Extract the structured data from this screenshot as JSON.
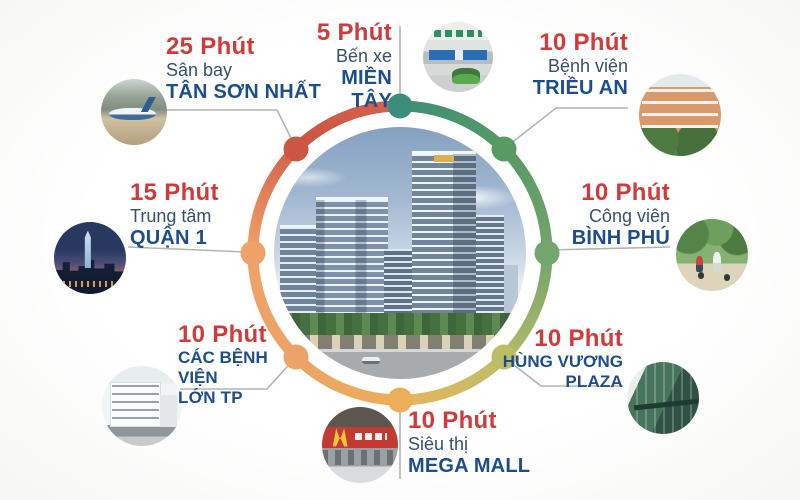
{
  "palette": {
    "time_red": "#d23a3a",
    "label_navy": "#35506e",
    "name_navy": "#1c4d8c",
    "connector_gray": "#b3b3b3",
    "ring": {
      "dot_nw": "#cd5643",
      "dot_n": "#3d8d7d",
      "dot_ne": "#579b63",
      "dot_e": "#74a56d",
      "dot_se": "#bcbd67",
      "dot_s": "#ecae58",
      "dot_sw": "#eda267",
      "dot_w": "#f0a169"
    }
  },
  "center": {
    "description": "twin high-rise apartment towers render"
  },
  "items": [
    {
      "id": "tan-son-nhat-airport",
      "time": "25 Phút",
      "line1": "Sân bay",
      "line2": "TÂN SƠN NHẤT"
    },
    {
      "id": "mien-tay-bus-station",
      "time": "5 Phút",
      "line1": "Bến xe",
      "line2": "MIỀN TÂY"
    },
    {
      "id": "trieu-an-hospital",
      "time": "10 Phút",
      "line1": "Bệnh viện",
      "line2": "TRIỀU AN"
    },
    {
      "id": "binh-phu-park",
      "time": "10 Phút",
      "line1": "Công viên",
      "line2": "BÌNH PHÚ"
    },
    {
      "id": "hung-vuong-plaza",
      "time": "10 Phút",
      "line1": "HÙNG VƯƠNG",
      "line2": "PLAZA"
    },
    {
      "id": "mega-mall",
      "time": "10 Phút",
      "line1": "Siêu thị",
      "line2": "MEGA MALL"
    },
    {
      "id": "city-hospitals",
      "time": "10 Phút",
      "line1": "CÁC BỆNH VIỆN",
      "line2": "LỚN TP"
    },
    {
      "id": "district-1-center",
      "time": "15 Phút",
      "line1": "Trung tâm",
      "line2": "QUẬN 1"
    }
  ]
}
